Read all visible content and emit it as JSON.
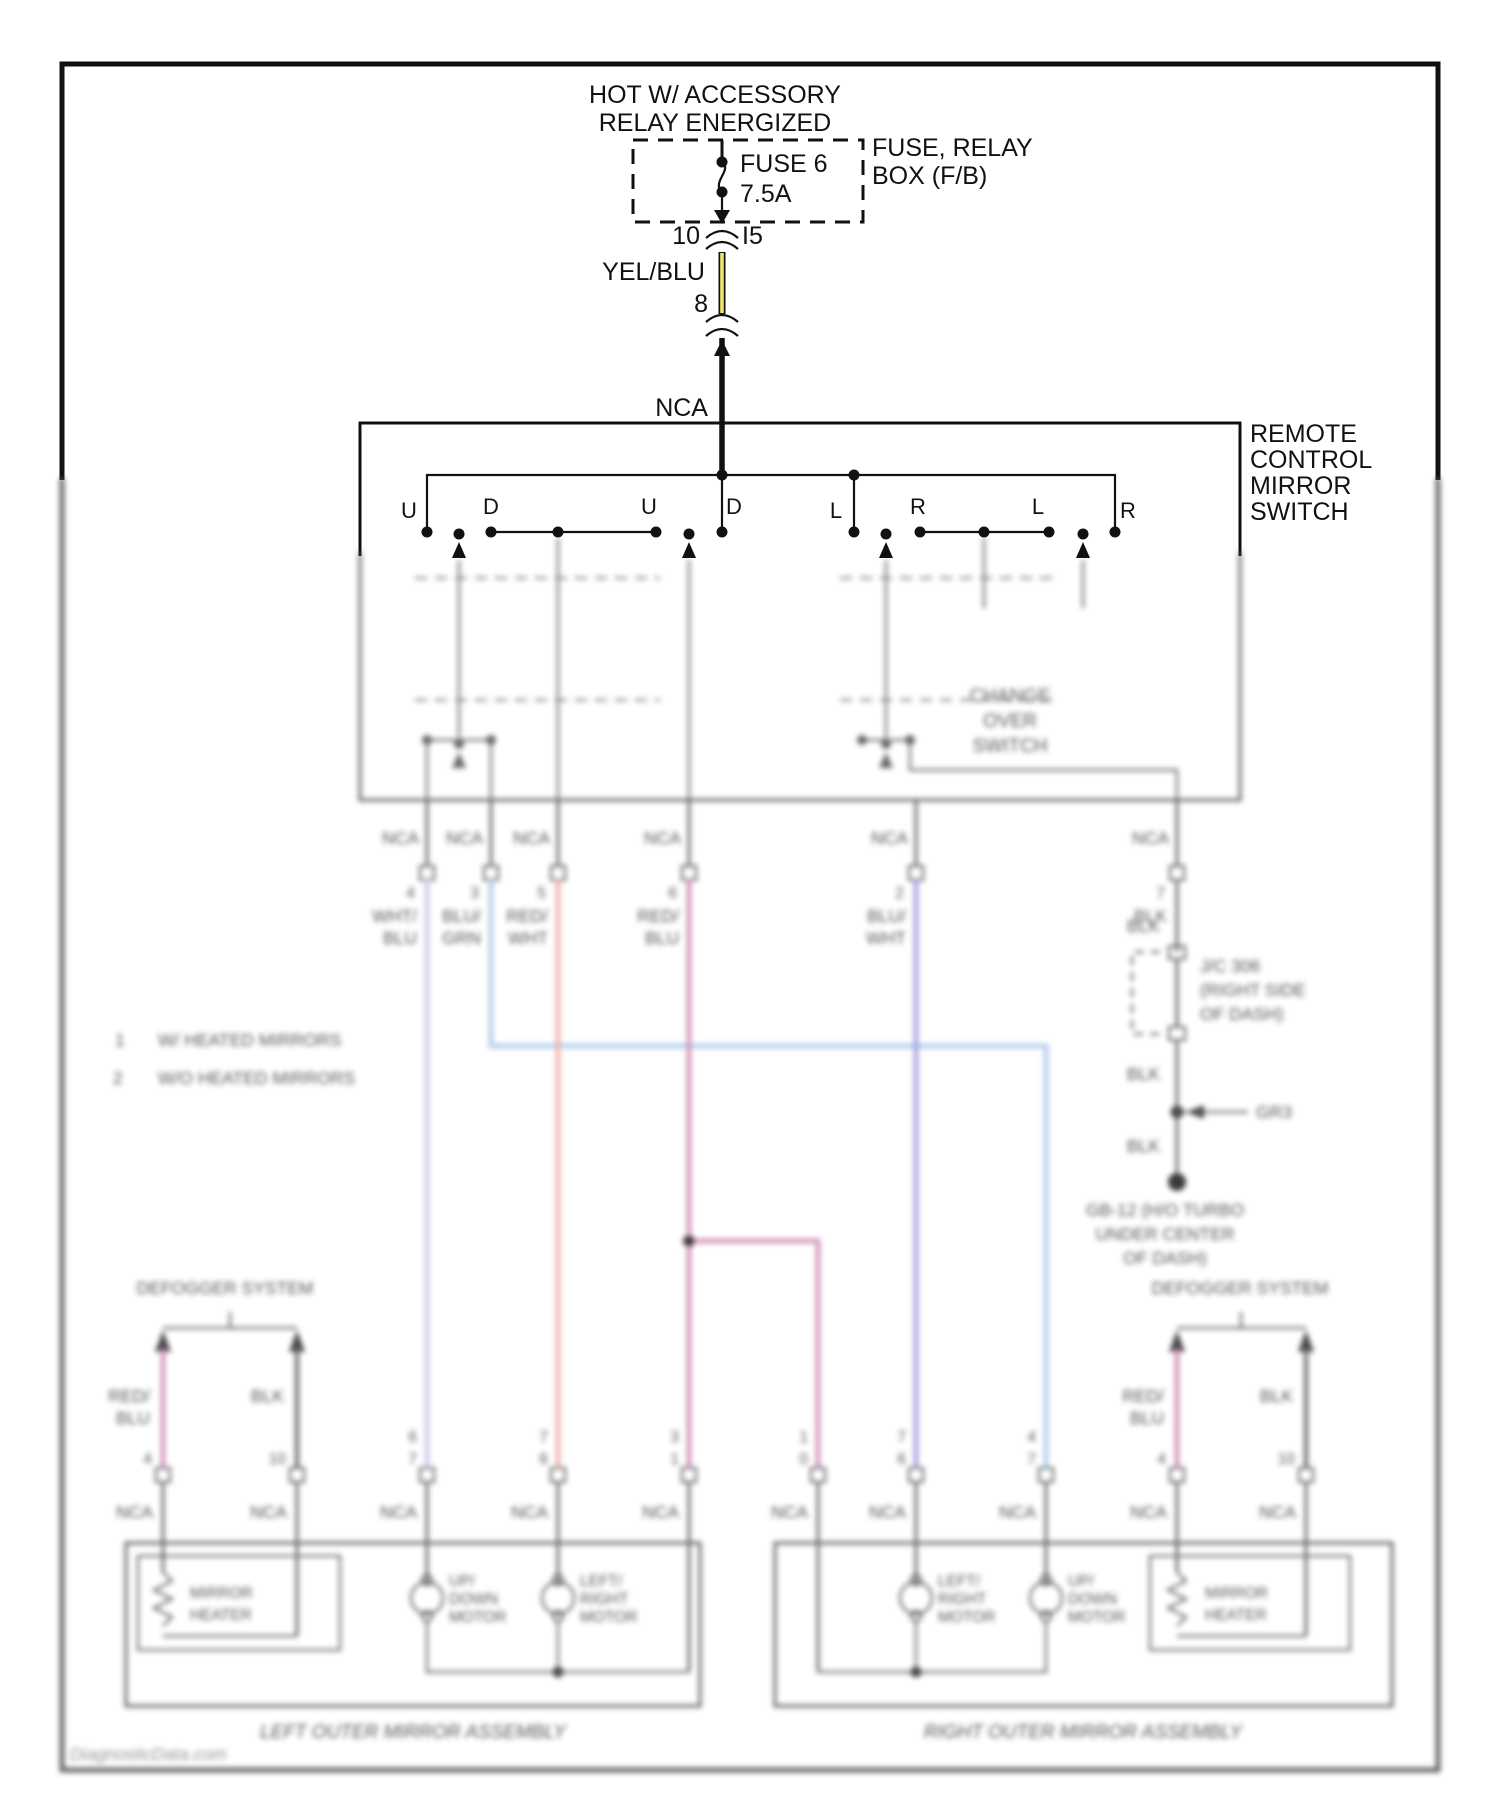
{
  "labels": {
    "nca": "NCA"
  },
  "top": {
    "hot1": "HOT W/ ACCESSORY",
    "hot2": "RELAY ENERGIZED",
    "fuse_name": "FUSE 6",
    "fuse_amp": "7.5A",
    "fusebox1": "FUSE, RELAY",
    "fusebox2": "BOX (F/B)",
    "pin10": "10",
    "pin_i5": "I5",
    "wire_color": "YEL/BLU",
    "pin8": "8"
  },
  "switch": {
    "label": [
      "REMOTE",
      "CONTROL",
      "MIRROR",
      "SWITCH"
    ],
    "contacts": [
      "U",
      "D",
      "U",
      "D",
      "L",
      "R",
      "L",
      "R"
    ],
    "changeover": [
      "CHANGE",
      "OVER",
      "SWITCH"
    ]
  },
  "exits": [
    {
      "pin": "4",
      "l1": "WHT/",
      "l2": "BLU"
    },
    {
      "pin": "3",
      "l1": "BLU/",
      "l2": "GRN"
    },
    {
      "pin": "5",
      "l1": "RED/",
      "l2": "WHT"
    },
    {
      "pin": "6",
      "l1": "RED/",
      "l2": "BLU"
    },
    {
      "pin": "2",
      "l1": "BLU/",
      "l2": "WHT"
    },
    {
      "pin": "7",
      "l1": "BLK",
      "l2": ""
    }
  ],
  "ground_chain": {
    "blk1": "BLK",
    "jc": [
      "J/C 306",
      "(RIGHT SIDE",
      "OF DASH)"
    ],
    "blk2": "BLK",
    "splice": "GR3",
    "blk3": "BLK",
    "gnd": [
      "GB-12 (H/O TURBO",
      "UNDER CENTER",
      "OF DASH)"
    ]
  },
  "notes": [
    {
      "num": "1",
      "text": "W/ HEATED MIRRORS"
    },
    {
      "num": "2",
      "text": "W/O HEATED MIRRORS"
    }
  ],
  "defogger_left": {
    "title": "DEFOGGER SYSTEM",
    "w1l1": "RED/",
    "w1l2": "BLU",
    "w1pin": "4",
    "w2l1": "BLK",
    "w2pin": "10"
  },
  "defogger_right": {
    "title": "DEFOGGER SYSTEM",
    "w1l1": "RED/",
    "w1l2": "BLU",
    "w1pin": "4",
    "w2l1": "BLK",
    "w2pin": "10"
  },
  "entries_left": [
    {
      "p1": "6",
      "p2": "7",
      "l1": "WHT/",
      "l2": "BLU"
    },
    {
      "p1": "7",
      "p2": "6",
      "l1": "RED/",
      "l2": "WHT"
    },
    {
      "p1": "3",
      "p2": "1",
      "l1": "RED/",
      "l2": "BLU"
    }
  ],
  "entries_right": [
    {
      "p1": "1",
      "p2": "0",
      "l1": "RED/",
      "l2": "BLU"
    },
    {
      "p1": "7",
      "p2": "6",
      "l1": "BLU/",
      "l2": "WHT"
    },
    {
      "p1": "4",
      "p2": "7",
      "l1": "BLU/",
      "l2": "GRN"
    }
  ],
  "assembly_left": {
    "label": "LEFT OUTER MIRROR ASSEMBLY",
    "heater": [
      "MIRROR",
      "HEATER"
    ],
    "motor1": [
      "UP/",
      "DOWN",
      "MOTOR"
    ],
    "motor2": [
      "LEFT/",
      "RIGHT",
      "MOTOR"
    ]
  },
  "assembly_right": {
    "label": "RIGHT OUTER MIRROR ASSEMBLY",
    "heater": [
      "MIRROR",
      "HEATER"
    ],
    "motor1": [
      "LEFT/",
      "RIGHT",
      "MOTOR"
    ],
    "motor2": [
      "UP/",
      "DOWN",
      "MOTOR"
    ]
  },
  "watermark": "DiagnosticData.com",
  "colors": {
    "yellow_wire": "#ece96e",
    "wht_blu": "#c6c2ea",
    "blu_grn": "#a9c6e6",
    "red_wht": "#eda9a2",
    "red_blu": "#cb86b0",
    "blu_wht": "#9c95da",
    "blk_wire": "#6a6a6a"
  }
}
